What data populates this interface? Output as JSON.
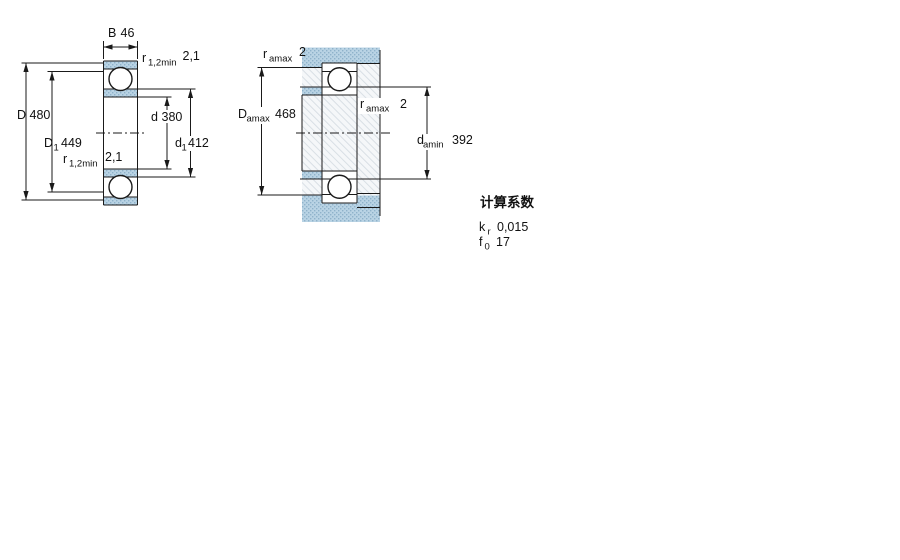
{
  "figure1": {
    "name": "bearing-cross-section",
    "dim_B": {
      "symbol": "B",
      "value": "46"
    },
    "dim_r_top": {
      "symbol": "r",
      "subscript": "1,2min",
      "value": "2,1"
    },
    "dim_D": {
      "symbol": "D",
      "value": "480"
    },
    "dim_D1": {
      "symbol": "D",
      "subscript": "1",
      "value": "449"
    },
    "dim_r_bottom": {
      "symbol": "r",
      "subscript": "1,2min",
      "value": "2,1"
    },
    "dim_d": {
      "symbol": "d",
      "value": "380"
    },
    "dim_d1": {
      "symbol": "d",
      "subscript": "1",
      "value": "412"
    }
  },
  "figure2": {
    "name": "abutment-and-fillet-dimensions",
    "dim_ra_top": {
      "symbol": "r",
      "subscript": "amax",
      "value": "2"
    },
    "dim_Damax": {
      "symbol": "D",
      "subscript": "amax",
      "value": "468"
    },
    "dim_ra_right": {
      "symbol": "r",
      "subscript": "amax",
      "value": "2"
    },
    "dim_damin": {
      "symbol": "d",
      "subscript": "amin",
      "value": "392"
    }
  },
  "calculation_factors": {
    "title": "计算系数",
    "rows": [
      {
        "symbol": "k",
        "subscript": "r",
        "value": "0,015"
      },
      {
        "symbol": "f",
        "subscript": "0",
        "value": "17"
      }
    ]
  },
  "colors": {
    "ring_section_fill": "#b9d3e4",
    "ring_section_dot": "#8fb2ca",
    "shaft_hatch_line": "#d9dfe5",
    "drawing_line": "#1a1a1a",
    "background": "#ffffff"
  }
}
